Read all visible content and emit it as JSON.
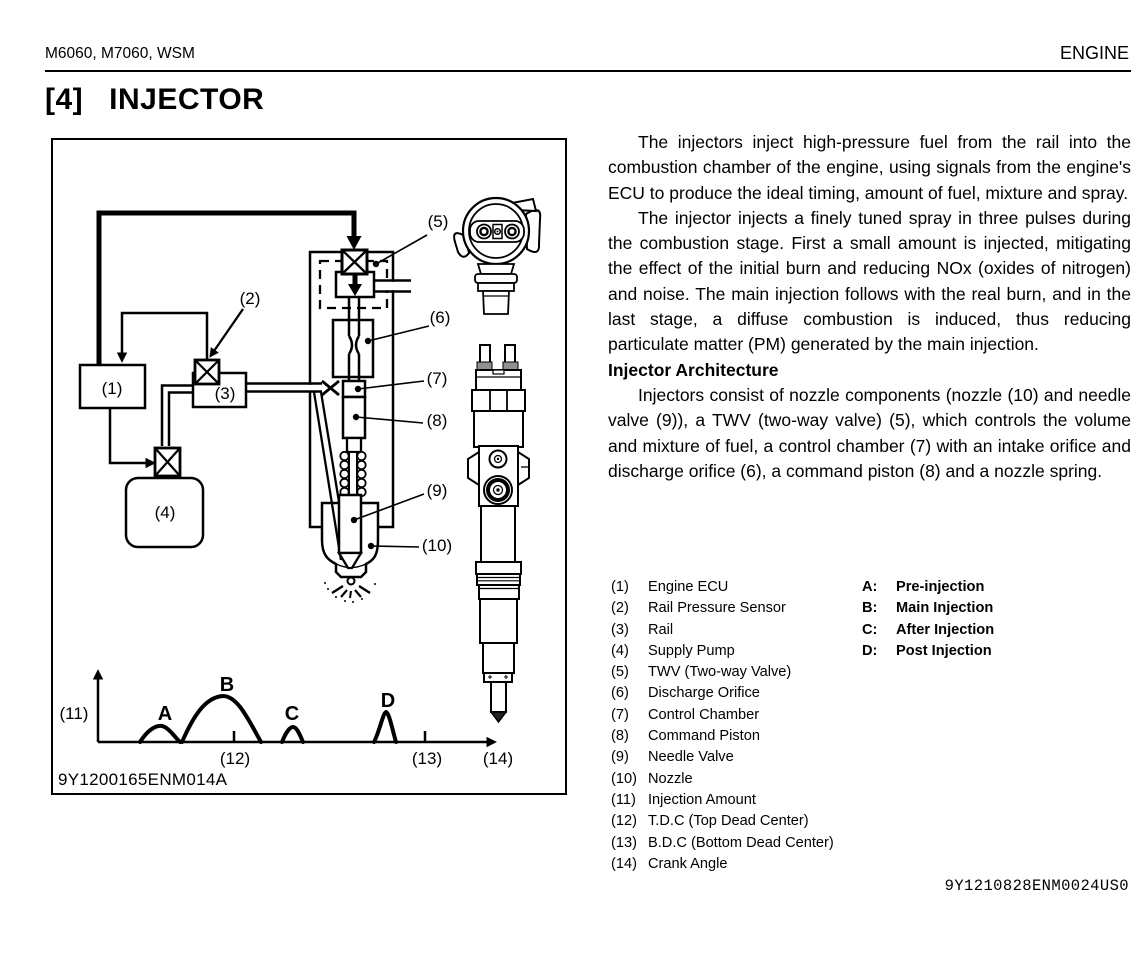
{
  "page": {
    "header_left": "M6060, M7060, WSM",
    "header_right": "ENGINE",
    "section_number": "[4]",
    "section_title": "INJECTOR",
    "footer_code": "9Y1210828ENM0024US0"
  },
  "body": {
    "para1": "The injectors inject high-pressure fuel from the rail into the combustion chamber of the engine, using signals from the engine's ECU to produce the ideal timing, amount of fuel, mixture and spray.",
    "para2": "The injector injects a finely tuned spray in three pulses during the combustion stage. First a small amount is injected, mitigating the effect of the initial burn and reducing NOx (oxides of nitrogen) and noise. The main injection follows with the real burn, and in the last stage, a diffuse combustion is induced, thus reducing particulate matter (PM) generated by the main injection.",
    "subheading": "Injector Architecture",
    "para3": "Injectors consist of nozzle components (nozzle (10) and needle valve (9)), a TWV (two-way valve) (5), which controls the volume and mixture of fuel, a control chamber (7) with an intake orifice and discharge orifice (6), a command piston (8) and a nozzle spring."
  },
  "figure": {
    "caption_code": "9Y1200165ENM014A",
    "callouts": {
      "c1": "(1)",
      "c2": "(2)",
      "c3": "(3)",
      "c4": "(4)",
      "c5": "(5)",
      "c6": "(6)",
      "c7": "(7)",
      "c8": "(8)",
      "c9": "(9)",
      "c10": "(10)",
      "c11": "(11)",
      "c12": "(12)",
      "c13": "(13)",
      "c14": "(14)",
      "A": "A",
      "B": "B",
      "C": "C",
      "D": "D"
    }
  },
  "legend": {
    "numbered": [
      {
        "num": "(1)",
        "label": "Engine ECU"
      },
      {
        "num": "(2)",
        "label": "Rail Pressure Sensor"
      },
      {
        "num": "(3)",
        "label": "Rail"
      },
      {
        "num": "(4)",
        "label": "Supply Pump"
      },
      {
        "num": "(5)",
        "label": "TWV (Two-way Valve)"
      },
      {
        "num": "(6)",
        "label": "Discharge Orifice"
      },
      {
        "num": "(7)",
        "label": "Control Chamber"
      },
      {
        "num": "(8)",
        "label": "Command Piston"
      },
      {
        "num": "(9)",
        "label": "Needle Valve"
      },
      {
        "num": "(10)",
        "label": "Nozzle"
      },
      {
        "num": "(11)",
        "label": "Injection Amount"
      },
      {
        "num": "(12)",
        "label": "T.D.C (Top Dead Center)"
      },
      {
        "num": "(13)",
        "label": "B.D.C (Bottom Dead Center)"
      },
      {
        "num": "(14)",
        "label": "Crank Angle"
      }
    ],
    "letters": [
      {
        "key": "A:",
        "label": "Pre-injection"
      },
      {
        "key": "B:",
        "label": "Main Injection"
      },
      {
        "key": "C:",
        "label": "After Injection"
      },
      {
        "key": "D:",
        "label": "Post Injection"
      }
    ]
  },
  "chart_data": {
    "type": "line",
    "title": "Injection rate vs crank angle",
    "xlabel": "(14) Crank Angle",
    "ylabel": "(11) Injection Amount",
    "x_axis_markers": [
      "(12) T.D.C (Top Dead Center)",
      "(13) B.D.C (Bottom Dead Center)"
    ],
    "grid": false,
    "peaks": [
      {
        "label": "A",
        "meaning": "Pre-injection",
        "x_rel": 0.17,
        "height_rel": 0.22
      },
      {
        "label": "B",
        "meaning": "Main Injection",
        "x_rel": 0.32,
        "height_rel": 0.63
      },
      {
        "label": "C",
        "meaning": "After Injection",
        "x_rel": 0.49,
        "height_rel": 0.21
      },
      {
        "label": "D",
        "meaning": "Post Injection",
        "x_rel": 0.73,
        "height_rel": 0.42
      }
    ]
  }
}
